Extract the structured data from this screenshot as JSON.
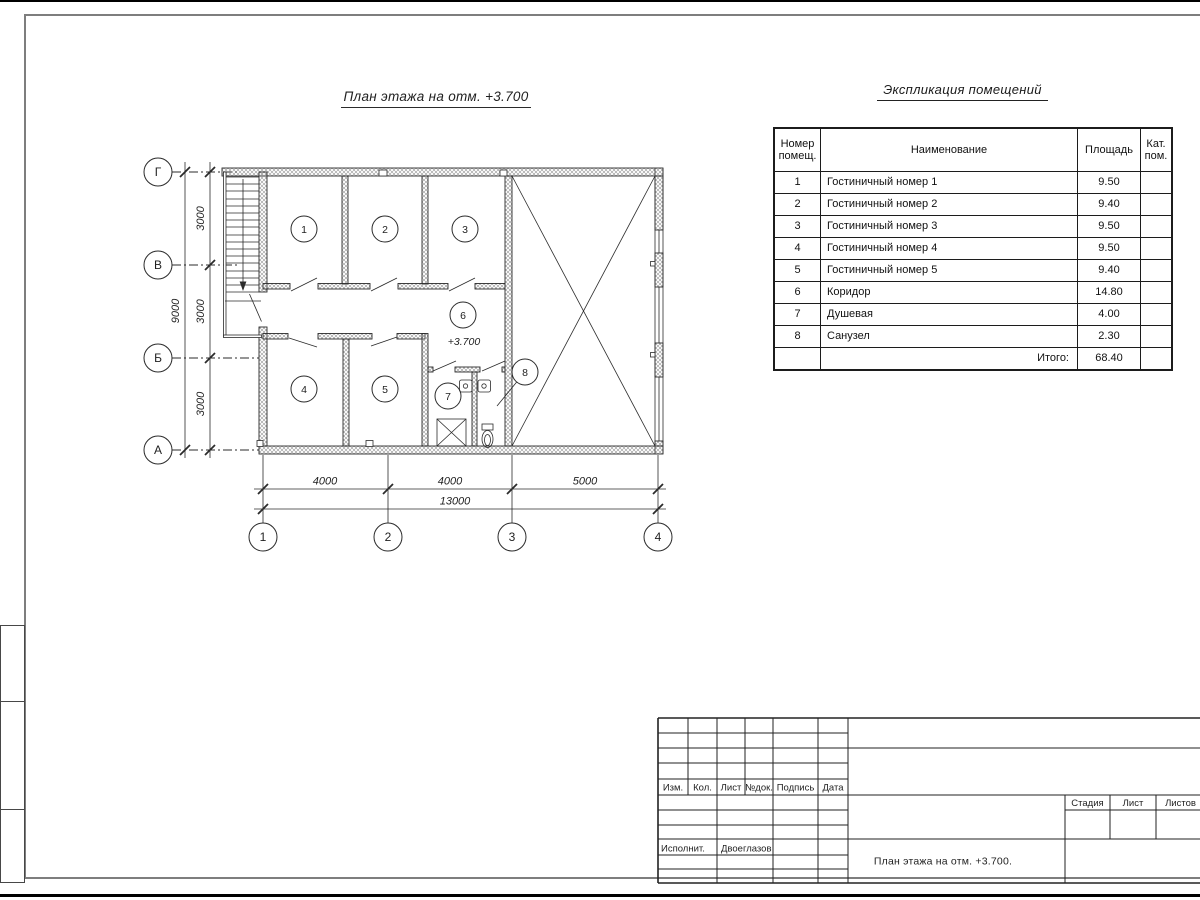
{
  "colors": {
    "ink": "#1f1f1f",
    "frame_gray": "#7e7e7e"
  },
  "plan": {
    "title": "План этажа на отм. +3.700",
    "elevation": "+3.700",
    "axes_rows": [
      "Г",
      "В",
      "Б",
      "А"
    ],
    "axes_cols": [
      "1",
      "2",
      "3",
      "4"
    ],
    "dims_left": [
      "3000",
      "3000",
      "3000"
    ],
    "dim_left_total": "9000",
    "dims_bottom": [
      "4000",
      "4000",
      "5000"
    ],
    "dim_bottom_total": "13000",
    "rooms": [
      "1",
      "2",
      "3",
      "4",
      "5",
      "6",
      "7",
      "8"
    ]
  },
  "schedule": {
    "title": "Экспликация помещений",
    "col_headers": [
      "Номер помещ.",
      "Наименование",
      "Площадь",
      "Кат. пом."
    ],
    "rows": [
      {
        "num": "1",
        "name": "Гостиничный номер 1",
        "area": "9.50",
        "cat": ""
      },
      {
        "num": "2",
        "name": "Гостиничный номер 2",
        "area": "9.40",
        "cat": ""
      },
      {
        "num": "3",
        "name": "Гостиничный номер 3",
        "area": "9.50",
        "cat": ""
      },
      {
        "num": "4",
        "name": "Гостиничный номер 4",
        "area": "9.50",
        "cat": ""
      },
      {
        "num": "5",
        "name": "Гостиничный номер 5",
        "area": "9.40",
        "cat": ""
      },
      {
        "num": "6",
        "name": "Коридор",
        "area": "14.80",
        "cat": ""
      },
      {
        "num": "7",
        "name": "Душевая",
        "area": "4.00",
        "cat": ""
      },
      {
        "num": "8",
        "name": "Санузел",
        "area": "2.30",
        "cat": ""
      }
    ],
    "total_label": "Итого:",
    "total_value": "68.40"
  },
  "title_block": {
    "cols": [
      "Изм.",
      "Кол.",
      "Лист",
      "№док.",
      "Подпись",
      "Дата"
    ],
    "executor_label": "Исполнит.",
    "executor_name": "Двоеглазов",
    "doc_title": "План этажа на отм. +3.700.",
    "stage": "Стадия",
    "sheet": "Лист",
    "sheets": "Листов"
  }
}
